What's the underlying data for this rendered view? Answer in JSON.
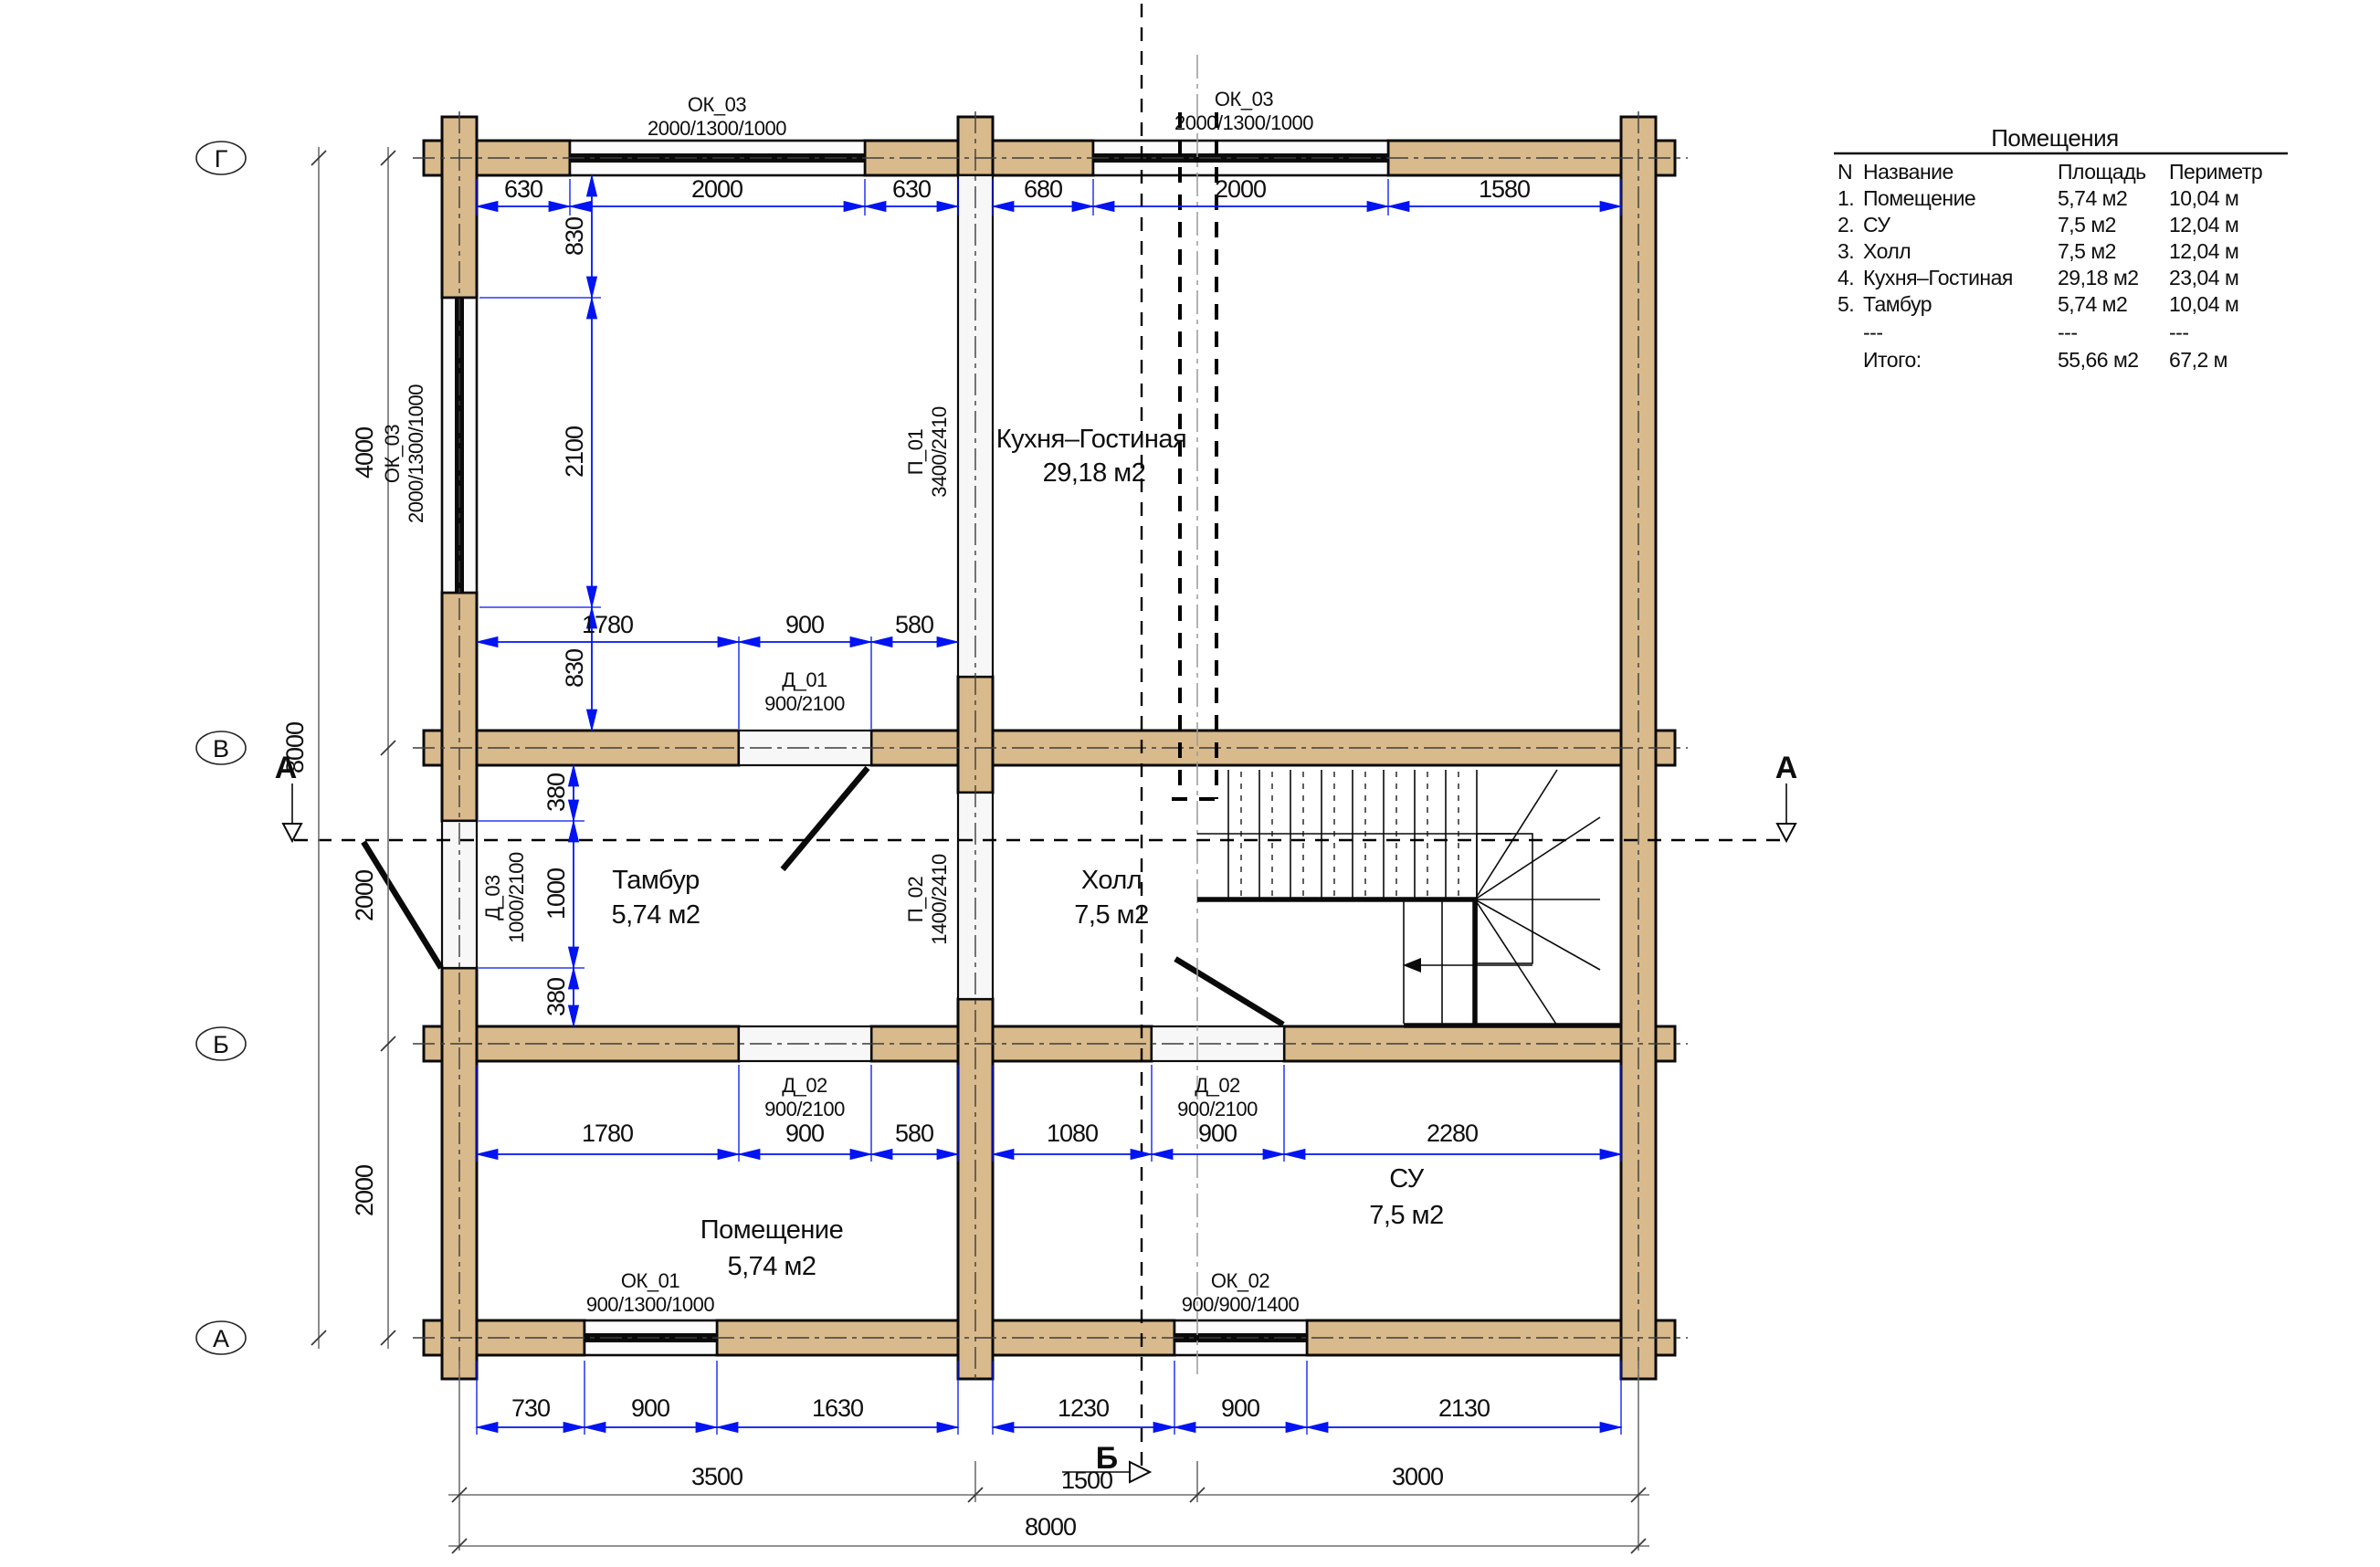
{
  "axes": {
    "bubbles": [
      "Г",
      "В",
      "Б",
      "А"
    ]
  },
  "sections": {
    "a_left": "А",
    "a_right": "А",
    "b_bottom": "Б"
  },
  "dims": {
    "top": [
      "630",
      "2000",
      "630",
      "680",
      "2000",
      "1580"
    ],
    "kitchen_v": [
      "830",
      "2100",
      "830"
    ],
    "kitchen_h": [
      "1780",
      "900",
      "580"
    ],
    "tambur_v": [
      "380",
      "1000",
      "380"
    ],
    "under_b": [
      "1780",
      "900",
      "580",
      "1080",
      "900",
      "2280"
    ],
    "bottom": [
      "730",
      "900",
      "1630",
      "1230",
      "900",
      "2130"
    ],
    "left": [
      "4000",
      "2000",
      "2000"
    ],
    "left_total": "8000",
    "bottom_axes": [
      "3500",
      "1500",
      "3000"
    ],
    "bottom_total": "8000"
  },
  "openings": {
    "ok03_top_left": {
      "code": "ОК_03",
      "size": "2000/1300/1000"
    },
    "ok03_top_right": {
      "code": "ОК_03",
      "size": "2000/1300/1000"
    },
    "ok03_left": {
      "code": "ОК_03",
      "size": "2000/1300/1000"
    },
    "ok01": {
      "code": "ОК_01",
      "size": "900/1300/1000"
    },
    "ok02": {
      "code": "ОК_02",
      "size": "900/900/1400"
    },
    "d01": {
      "code": "Д_01",
      "size": "900/2100"
    },
    "d02_left": {
      "code": "Д_02",
      "size": "900/2100"
    },
    "d02_right": {
      "code": "Д_02",
      "size": "900/2100"
    },
    "d03": {
      "code": "Д_03",
      "size": "1000/2100"
    },
    "p01": {
      "code": "П_01",
      "size": "3400/2410"
    },
    "p02": {
      "code": "П_02",
      "size": "1400/2410"
    }
  },
  "rooms": [
    {
      "name": "Кухня–Гостиная",
      "area": "29,18 м2"
    },
    {
      "name": "Тамбур",
      "area": "5,74 м2"
    },
    {
      "name": "Холл",
      "area": "7,5 м2"
    },
    {
      "name": "Помещение",
      "area": "5,74 м2"
    },
    {
      "name": "СУ",
      "area": "7,5 м2"
    }
  ],
  "table": {
    "title": "Помещения",
    "headers": [
      "N",
      "Название",
      "Площадь",
      "Периметр"
    ],
    "rows": [
      {
        "n": "1.",
        "name": "Помещение",
        "area": "5,74 м2",
        "perimeter": "10,04 м"
      },
      {
        "n": "2.",
        "name": "СУ",
        "area": "7,5 м2",
        "perimeter": "12,04 м"
      },
      {
        "n": "3.",
        "name": "Холл",
        "area": "7,5 м2",
        "perimeter": "12,04 м"
      },
      {
        "n": "4.",
        "name": "Кухня–Гостиная",
        "area": "29,18 м2",
        "perimeter": "23,04 м"
      },
      {
        "n": "5.",
        "name": "Тамбур",
        "area": "5,74 м2",
        "perimeter": "10,04 м"
      },
      {
        "n": "",
        "name": "---",
        "area": "---",
        "perimeter": "---"
      },
      {
        "n": "",
        "name": "Итого:",
        "area": "55,66 м2",
        "perimeter": "67,2 м"
      }
    ]
  }
}
